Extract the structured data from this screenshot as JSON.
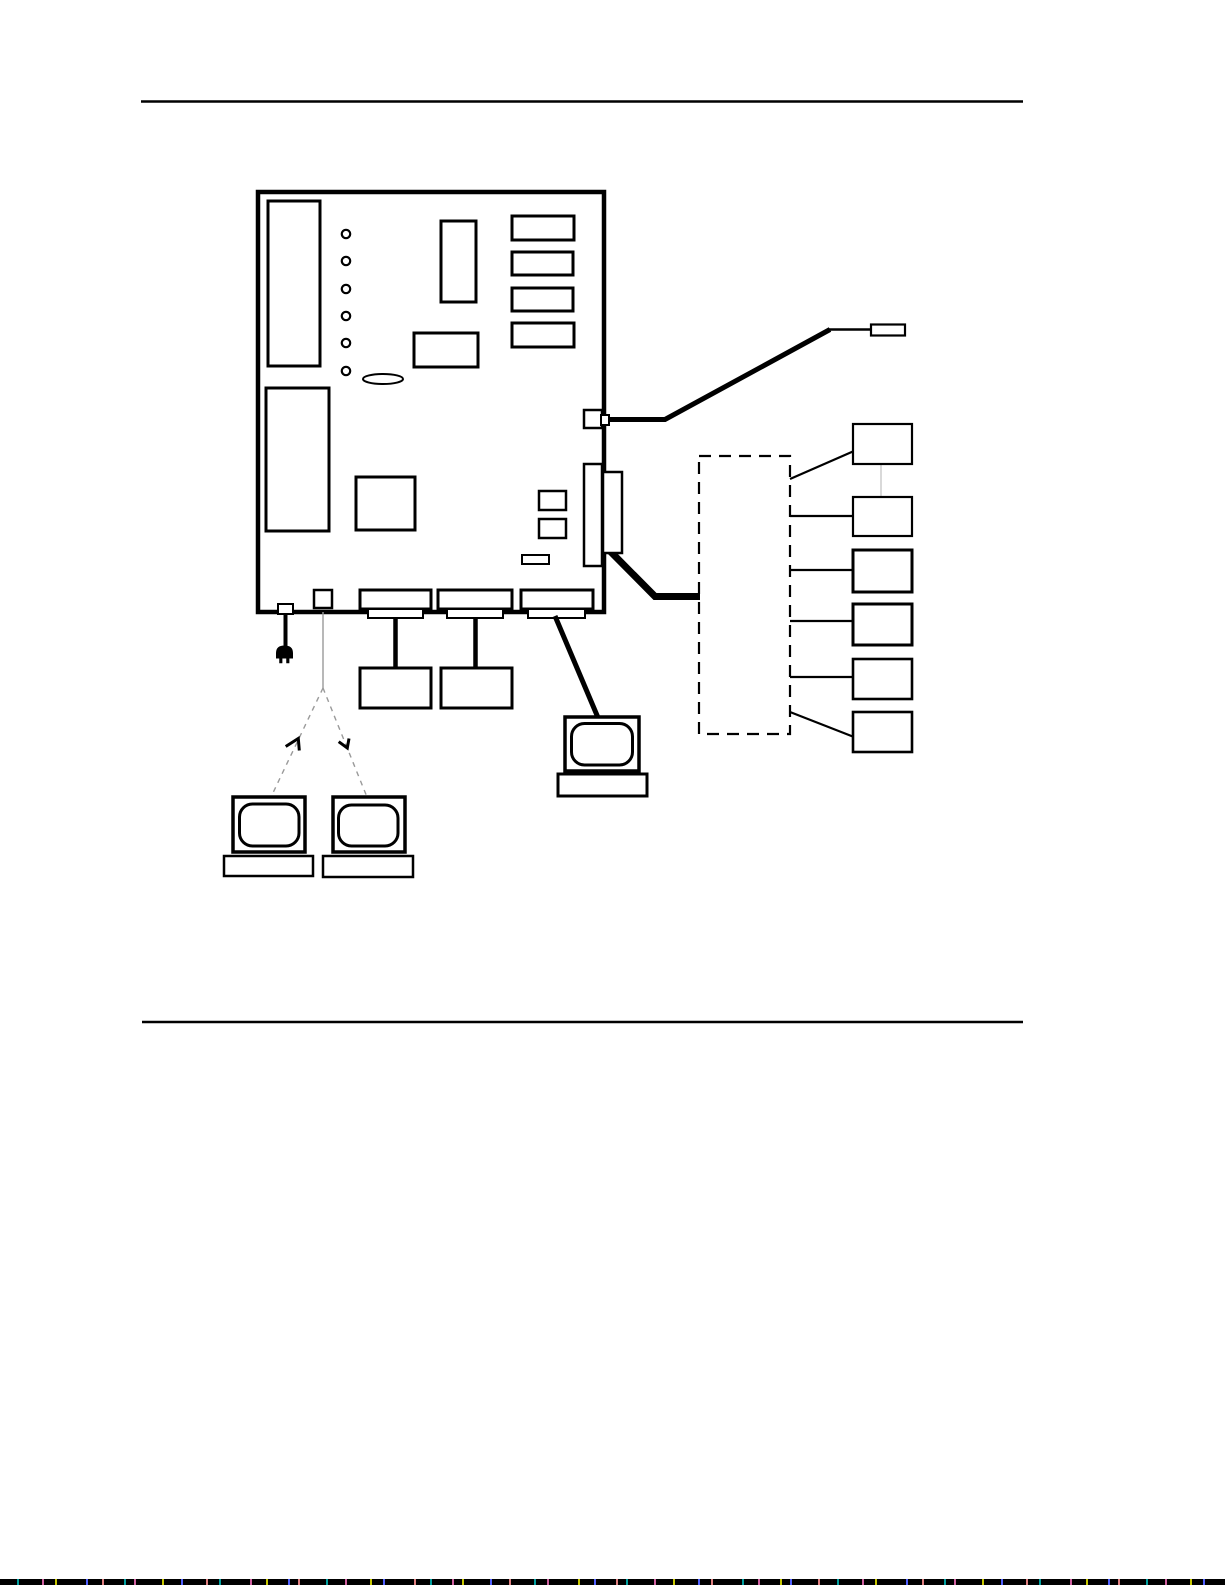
{
  "canvas": {
    "width": 1225,
    "height": 1585
  },
  "palette": {
    "ink": "#000000",
    "paper": "#ffffff",
    "faint": "#9a9a9a",
    "faint_light": "#bfbfbf",
    "strip_base": "#000000",
    "strip_speckles": [
      "#00a0a0",
      "#d060a0",
      "#c8c800",
      "#5060ff",
      "#e08080"
    ]
  },
  "diagram": {
    "shapes": [
      {
        "n": "rule-top",
        "t": "line",
        "x1": 141,
        "y1": 101.5,
        "x2": 1023,
        "y2": 101.5,
        "sw": 2.5
      },
      {
        "n": "rule-bottom",
        "t": "line",
        "x1": 142,
        "y1": 1022,
        "x2": 1023,
        "y2": 1022,
        "sw": 2.5
      },
      {
        "n": "system-board-outline",
        "t": "rect",
        "x": 258,
        "y": 192,
        "w": 346,
        "h": 420,
        "sw": 4.5,
        "f": "#ffffff"
      },
      {
        "n": "rom-bank-rect",
        "t": "rect",
        "x": 268,
        "y": 201,
        "w": 52,
        "h": 165,
        "sw": 3
      },
      {
        "n": "led-1",
        "t": "circle",
        "cx": 346,
        "cy": 234,
        "r": 4.2,
        "sw": 2.2
      },
      {
        "n": "led-2",
        "t": "circle",
        "cx": 346,
        "cy": 261,
        "r": 4.2,
        "sw": 2.2
      },
      {
        "n": "led-3",
        "t": "circle",
        "cx": 346,
        "cy": 289,
        "r": 4.2,
        "sw": 2.2
      },
      {
        "n": "led-4",
        "t": "circle",
        "cx": 346,
        "cy": 316,
        "r": 4.2,
        "sw": 2.2
      },
      {
        "n": "led-5",
        "t": "circle",
        "cx": 346,
        "cy": 343,
        "r": 4.2,
        "sw": 2.2
      },
      {
        "n": "led-6",
        "t": "circle",
        "cx": 346,
        "cy": 371,
        "r": 4.2,
        "sw": 2.2
      },
      {
        "n": "vertical-chip-rect",
        "t": "rect",
        "x": 441,
        "y": 221,
        "w": 35,
        "h": 81,
        "sw": 3
      },
      {
        "n": "memory-bank-rect-1",
        "t": "rect",
        "x": 512,
        "y": 216,
        "w": 62,
        "h": 24,
        "sw": 3
      },
      {
        "n": "memory-bank-rect-2",
        "t": "rect",
        "x": 512,
        "y": 252,
        "w": 61,
        "h": 23,
        "sw": 3
      },
      {
        "n": "memory-bank-rect-3",
        "t": "rect",
        "x": 512,
        "y": 288,
        "w": 61,
        "h": 23,
        "sw": 3
      },
      {
        "n": "memory-bank-rect-4",
        "t": "rect",
        "x": 512,
        "y": 323,
        "w": 62,
        "h": 24,
        "sw": 3
      },
      {
        "n": "horizontal-chip-rect",
        "t": "rect",
        "x": 414,
        "y": 333,
        "w": 64,
        "h": 34,
        "sw": 3
      },
      {
        "n": "jumper-ellipse",
        "t": "ellipse",
        "cx": 383,
        "cy": 379,
        "rx": 20,
        "ry": 5,
        "sw": 2
      },
      {
        "n": "expansion-area-rect",
        "t": "rect",
        "x": 266,
        "y": 388,
        "w": 63,
        "h": 143,
        "sw": 3
      },
      {
        "n": "processor-square",
        "t": "rect",
        "x": 356,
        "y": 477,
        "w": 59,
        "h": 53,
        "sw": 3
      },
      {
        "n": "small-chip-1",
        "t": "rect",
        "x": 539,
        "y": 491,
        "w": 27,
        "h": 19,
        "sw": 2.5
      },
      {
        "n": "small-chip-2",
        "t": "rect",
        "x": 539,
        "y": 519,
        "w": 27,
        "h": 19,
        "sw": 2.5
      },
      {
        "n": "small-component-rect",
        "t": "rect",
        "x": 522,
        "y": 555,
        "w": 27,
        "h": 9,
        "sw": 2
      },
      {
        "n": "serial-cable",
        "t": "poly",
        "p": "607,419.5 665,419.5 830,329.5",
        "sw": 5
      },
      {
        "n": "serial-cable-tail",
        "t": "line",
        "x1": 828,
        "y1": 329.5,
        "x2": 873,
        "y2": 329.5,
        "sw": 2.5
      },
      {
        "n": "scsi-cable",
        "t": "poly",
        "p": "609,550 655,596.5 700,596.5",
        "sw": 7
      },
      {
        "n": "side-port-small",
        "t": "rect",
        "x": 584,
        "y": 410,
        "w": 18,
        "h": 18,
        "sw": 2.5,
        "f": "#ffffff"
      },
      {
        "n": "side-port-small-stub",
        "t": "rect",
        "x": 601,
        "y": 415,
        "w": 8,
        "h": 10,
        "sw": 2,
        "f": "#ffffff"
      },
      {
        "n": "edge-connector-inner",
        "t": "rect",
        "x": 584,
        "y": 464,
        "w": 18,
        "h": 102,
        "sw": 2.5,
        "f": "#ffffff"
      },
      {
        "n": "edge-connector-outer",
        "t": "rect",
        "x": 603,
        "y": 472,
        "w": 19,
        "h": 81,
        "sw": 2.5,
        "f": "#ffffff"
      },
      {
        "n": "bottom-edge-tab",
        "t": "rect",
        "x": 314,
        "y": 590,
        "w": 18,
        "h": 18,
        "sw": 2.5,
        "f": "#ffffff"
      },
      {
        "n": "power-connector",
        "t": "rect",
        "x": 278,
        "y": 604,
        "w": 15,
        "h": 10,
        "sw": 2,
        "f": "#ffffff"
      },
      {
        "n": "bottom-port-1-outer",
        "t": "rect",
        "x": 360,
        "y": 590,
        "w": 71,
        "h": 19,
        "sw": 3,
        "f": "#ffffff"
      },
      {
        "n": "bottom-port-1-inner",
        "t": "rect",
        "x": 368,
        "y": 609,
        "w": 55,
        "h": 9,
        "sw": 2,
        "f": "#ffffff"
      },
      {
        "n": "bottom-port-2-outer",
        "t": "rect",
        "x": 438,
        "y": 590,
        "w": 74,
        "h": 19,
        "sw": 3,
        "f": "#ffffff"
      },
      {
        "n": "bottom-port-2-inner",
        "t": "rect",
        "x": 447,
        "y": 609,
        "w": 56,
        "h": 9,
        "sw": 2,
        "f": "#ffffff"
      },
      {
        "n": "bottom-port-3-outer",
        "t": "rect",
        "x": 521,
        "y": 590,
        "w": 72,
        "h": 19,
        "sw": 3,
        "f": "#ffffff"
      },
      {
        "n": "bottom-port-3-inner",
        "t": "rect",
        "x": 528,
        "y": 609,
        "w": 57,
        "h": 9,
        "sw": 2,
        "f": "#ffffff"
      },
      {
        "n": "serial-connector",
        "t": "rect",
        "x": 871,
        "y": 324.5,
        "w": 34,
        "h": 11,
        "sw": 2.2,
        "f": "#ffffff"
      },
      {
        "n": "power-cord",
        "t": "line",
        "x1": 285.5,
        "y1": 613,
        "x2": 285.5,
        "y2": 649,
        "sw": 4
      },
      {
        "n": "power-plug-icon",
        "t": "path",
        "d": "M276.5,658 L276.5,653 Q276.5,646 284.5,646 Q292.5,646 292.5,653 L292.5,658 Z",
        "sw": 1,
        "f": "#000000"
      },
      {
        "n": "power-plug-prong-1",
        "t": "rect",
        "x": 279.5,
        "y": 658,
        "w": 2.6,
        "h": 5,
        "sw": 0.5,
        "f": "#000000"
      },
      {
        "n": "power-plug-prong-2",
        "t": "rect",
        "x": 286.5,
        "y": 658,
        "w": 2.6,
        "h": 5,
        "sw": 0.5,
        "f": "#000000"
      },
      {
        "n": "drive-cable-1",
        "t": "line",
        "x1": 395.5,
        "y1": 617,
        "x2": 395.5,
        "y2": 670,
        "sw": 4.5
      },
      {
        "n": "drive-cable-2",
        "t": "line",
        "x1": 475.5,
        "y1": 617,
        "x2": 475.5,
        "y2": 670,
        "sw": 4.5
      },
      {
        "n": "drive-box-1",
        "t": "rect",
        "x": 360,
        "y": 668,
        "w": 71,
        "h": 40,
        "sw": 3,
        "f": "#ffffff"
      },
      {
        "n": "drive-box-2",
        "t": "rect",
        "x": 441,
        "y": 668,
        "w": 71,
        "h": 40,
        "sw": 3,
        "f": "#ffffff"
      },
      {
        "n": "console-cable",
        "t": "line",
        "x1": 555,
        "y1": 616,
        "x2": 599,
        "y2": 720,
        "sw": 5
      },
      {
        "n": "console-monitor",
        "t": "rect",
        "x": 565,
        "y": 717,
        "w": 74,
        "h": 54,
        "sw": 3.5,
        "f": "#ffffff"
      },
      {
        "n": "console-screen",
        "t": "rect",
        "x": 571.5,
        "y": 723.5,
        "w": 61,
        "h": 41.5,
        "rx": 13,
        "sw": 3,
        "f": "#ffffff"
      },
      {
        "n": "console-base",
        "t": "rect",
        "x": 558,
        "y": 774,
        "w": 89,
        "h": 22,
        "sw": 3,
        "f": "#ffffff"
      },
      {
        "n": "option-line-vertical",
        "t": "line",
        "x1": 323,
        "y1": 612,
        "x2": 323,
        "y2": 688,
        "sw": 1.4,
        "st": "#9a9a9a"
      },
      {
        "n": "option-line-left",
        "t": "line",
        "x1": 323,
        "y1": 688,
        "x2": 271,
        "y2": 797,
        "sw": 1.4,
        "st": "#9a9a9a",
        "dash": "5,5"
      },
      {
        "n": "option-line-right",
        "t": "line",
        "x1": 323,
        "y1": 688,
        "x2": 367,
        "y2": 797,
        "sw": 1.4,
        "st": "#9a9a9a",
        "dash": "5,5"
      },
      {
        "n": "option-arrow-left-icon",
        "t": "poly",
        "p": "285.7,746.5 298.3,738.5 299.3,750.5",
        "sw": 3
      },
      {
        "n": "option-arrow-right-icon",
        "t": "poly",
        "p": "338.7,741.7 347.3,748 349,738.5",
        "sw": 3
      },
      {
        "n": "terminal-left-monitor",
        "t": "rect",
        "x": 233,
        "y": 797,
        "w": 72,
        "h": 55,
        "sw": 3.5,
        "f": "#ffffff"
      },
      {
        "n": "terminal-left-screen",
        "t": "rect",
        "x": 239.5,
        "y": 804,
        "w": 59.5,
        "h": 42,
        "rx": 13,
        "sw": 3,
        "f": "#ffffff"
      },
      {
        "n": "terminal-left-base",
        "t": "rect",
        "x": 224,
        "y": 856,
        "w": 89,
        "h": 20,
        "sw": 2.5,
        "f": "#ffffff"
      },
      {
        "n": "terminal-right-monitor",
        "t": "rect",
        "x": 333,
        "y": 797,
        "w": 72,
        "h": 55,
        "sw": 3.5,
        "f": "#ffffff"
      },
      {
        "n": "terminal-right-screen",
        "t": "rect",
        "x": 338.5,
        "y": 805,
        "w": 59.5,
        "h": 41,
        "rx": 13,
        "sw": 3,
        "f": "#ffffff"
      },
      {
        "n": "terminal-right-base",
        "t": "rect",
        "x": 323,
        "y": 856,
        "w": 90,
        "h": 21,
        "sw": 2.5,
        "f": "#ffffff"
      },
      {
        "n": "external-enclosure-dashed",
        "t": "rect",
        "x": 699,
        "y": 456,
        "w": 91,
        "h": 278,
        "sw": 2.2,
        "f": "none",
        "dash": "12,8"
      },
      {
        "n": "device-link-1",
        "t": "line",
        "x1": 790,
        "y1": 479,
        "x2": 854,
        "y2": 451,
        "sw": 2.2
      },
      {
        "n": "device-link-2",
        "t": "line",
        "x1": 790,
        "y1": 516,
        "x2": 854,
        "y2": 516,
        "sw": 2.2
      },
      {
        "n": "device-link-3",
        "t": "line",
        "x1": 790,
        "y1": 570,
        "x2": 854,
        "y2": 570,
        "sw": 2.2
      },
      {
        "n": "device-link-4",
        "t": "line",
        "x1": 790,
        "y1": 621,
        "x2": 854,
        "y2": 621,
        "sw": 2.2
      },
      {
        "n": "device-link-5",
        "t": "line",
        "x1": 790,
        "y1": 677,
        "x2": 854,
        "y2": 677,
        "sw": 2.2
      },
      {
        "n": "device-link-6",
        "t": "line",
        "x1": 790,
        "y1": 712,
        "x2": 854,
        "y2": 737,
        "sw": 2.2
      },
      {
        "n": "device-chain-link",
        "t": "line",
        "x1": 881,
        "y1": 464,
        "x2": 881,
        "y2": 497,
        "sw": 1.2,
        "st": "#bfbfbf"
      },
      {
        "n": "device-box-1",
        "t": "rect",
        "x": 853,
        "y": 424,
        "w": 59,
        "h": 40,
        "sw": 2.2,
        "f": "#ffffff"
      },
      {
        "n": "device-box-2",
        "t": "rect",
        "x": 853,
        "y": 497,
        "w": 59,
        "h": 39,
        "sw": 2.2,
        "f": "#ffffff"
      },
      {
        "n": "device-box-3",
        "t": "rect",
        "x": 853,
        "y": 550,
        "w": 59,
        "h": 42,
        "sw": 3,
        "f": "#ffffff"
      },
      {
        "n": "device-box-4",
        "t": "rect",
        "x": 853,
        "y": 604,
        "w": 59,
        "h": 41,
        "sw": 3,
        "f": "#ffffff"
      },
      {
        "n": "device-box-5",
        "t": "rect",
        "x": 853,
        "y": 659,
        "w": 59,
        "h": 40,
        "sw": 2.6,
        "f": "#ffffff"
      },
      {
        "n": "device-box-6",
        "t": "rect",
        "x": 853,
        "y": 712,
        "w": 59,
        "h": 40,
        "sw": 2.6,
        "f": "#ffffff"
      }
    ]
  },
  "scan_strip": {
    "height": 6
  }
}
